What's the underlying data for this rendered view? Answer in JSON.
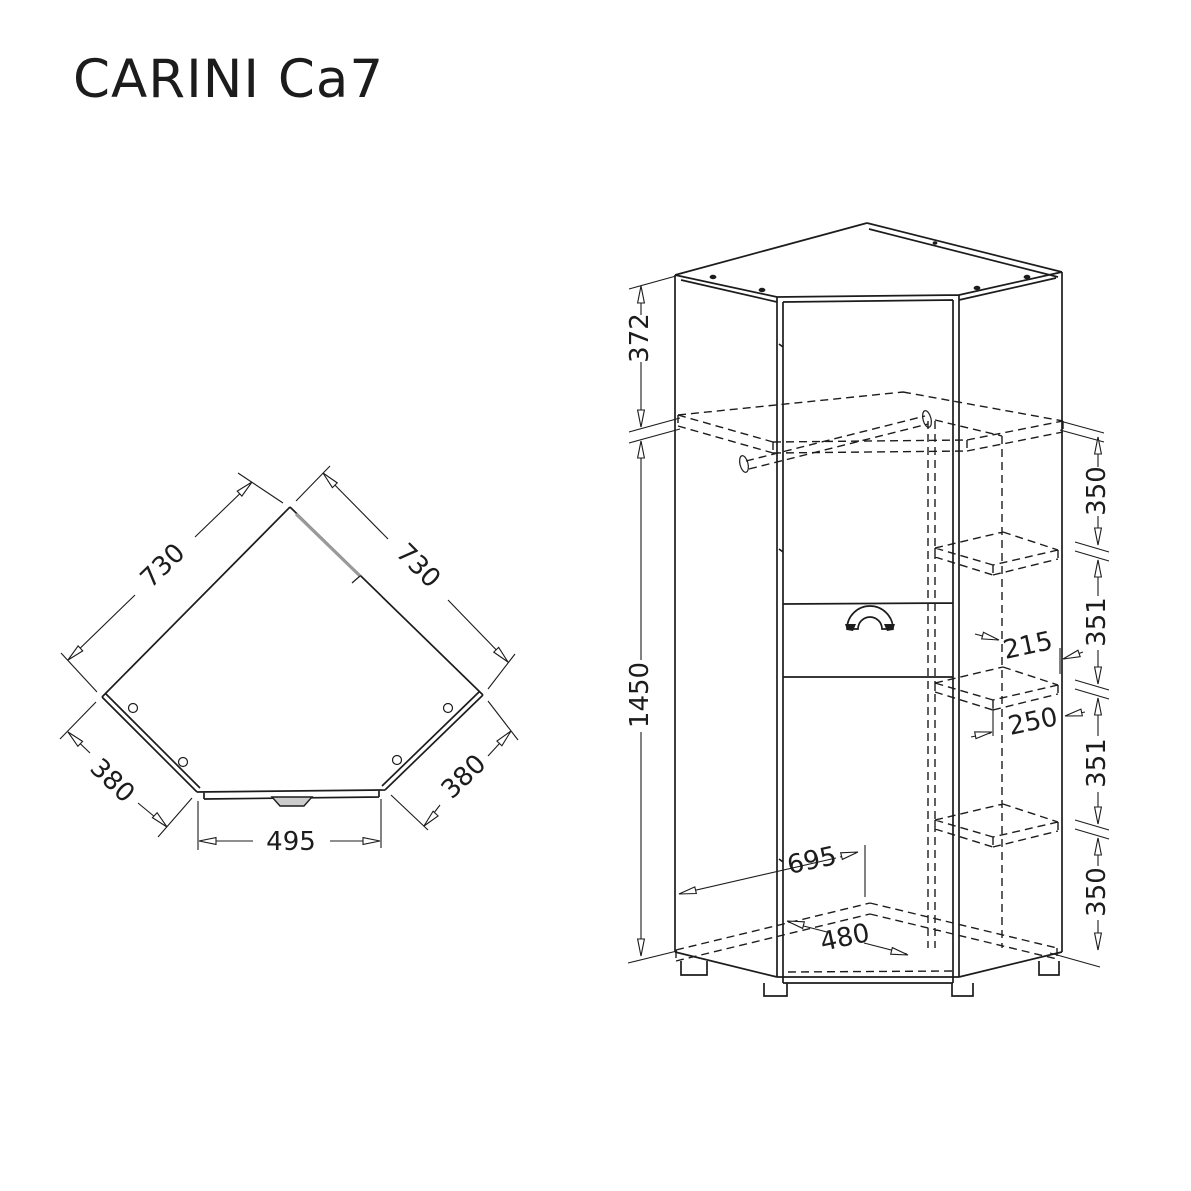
{
  "title": "CARINI Ca7",
  "colors": {
    "line": "#1c1c1c",
    "background": "#ffffff",
    "door_edge": "#9a9a9a",
    "handle_fill": "#cccccc"
  },
  "top_view": {
    "label_side_left": "730",
    "label_side_right": "730",
    "label_wing_left": "380",
    "label_wing_right": "380",
    "label_front_width": "495"
  },
  "front_view": {
    "label_top_section": "372",
    "label_height": "1450",
    "right_chain": [
      "350",
      "351",
      "351",
      "350"
    ],
    "label_shelf_depth": "215",
    "label_shelf_width": "250",
    "label_bottom_depth": "695",
    "label_bottom_width": "480"
  }
}
